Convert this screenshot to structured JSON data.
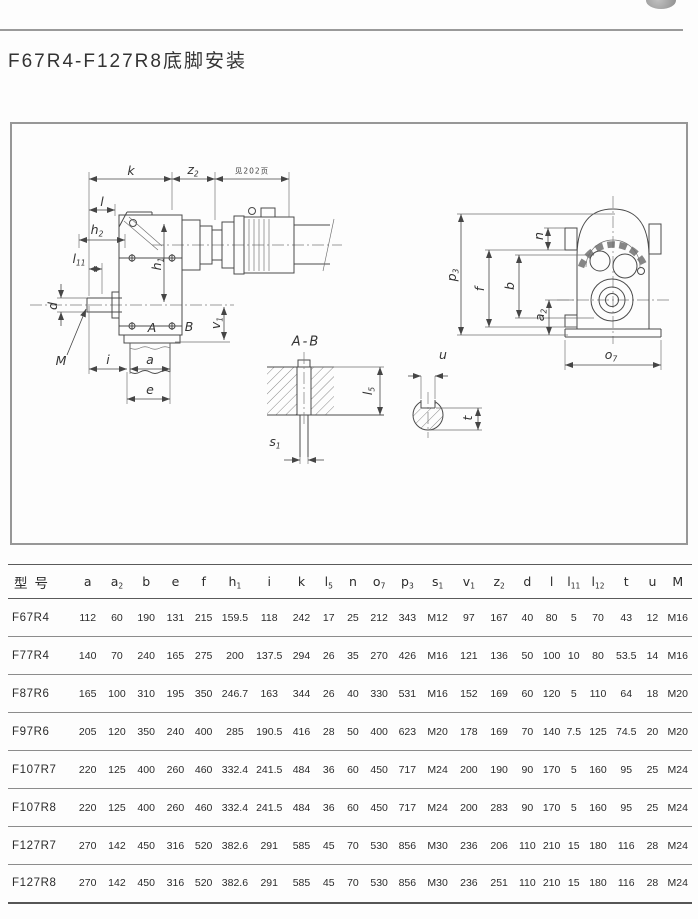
{
  "page": {
    "title": "F67R4-F127R8底脚安装"
  },
  "drawing": {
    "dims": {
      "k": {
        "base": "k",
        "sub": ""
      },
      "z2": {
        "base": "z",
        "sub": "2"
      },
      "note": {
        "base": "见202页",
        "sub": ""
      },
      "l": {
        "base": "l",
        "sub": ""
      },
      "h2": {
        "base": "h",
        "sub": "2"
      },
      "l11": {
        "base": "l",
        "sub": "11"
      },
      "d": {
        "base": "d",
        "sub": ""
      },
      "M": {
        "base": "M",
        "sub": ""
      },
      "i": {
        "base": "i",
        "sub": ""
      },
      "a": {
        "base": "a",
        "sub": ""
      },
      "e": {
        "base": "e",
        "sub": ""
      },
      "h1": {
        "base": "h",
        "sub": "1"
      },
      "A": {
        "base": "A",
        "sub": ""
      },
      "B": {
        "base": "B",
        "sub": ""
      },
      "v1": {
        "base": "v",
        "sub": "1"
      },
      "section": {
        "base": "A-B",
        "sub": ""
      },
      "s1": {
        "base": "s",
        "sub": "1"
      },
      "l5": {
        "base": "l",
        "sub": "5"
      },
      "u": {
        "base": "u",
        "sub": ""
      },
      "t": {
        "base": "t",
        "sub": ""
      },
      "p3": {
        "base": "p",
        "sub": "3"
      },
      "f": {
        "base": "f",
        "sub": ""
      },
      "b": {
        "base": "b",
        "sub": ""
      },
      "n": {
        "base": "n",
        "sub": ""
      },
      "a2": {
        "base": "a",
        "sub": "2"
      },
      "o7": {
        "base": "o",
        "sub": "7"
      }
    }
  },
  "table": {
    "headers": [
      {
        "base": "型号",
        "sub": ""
      },
      {
        "base": "a",
        "sub": ""
      },
      {
        "base": "a",
        "sub": "2"
      },
      {
        "base": "b",
        "sub": ""
      },
      {
        "base": "e",
        "sub": ""
      },
      {
        "base": "f",
        "sub": ""
      },
      {
        "base": "h",
        "sub": "1"
      },
      {
        "base": "i",
        "sub": ""
      },
      {
        "base": "k",
        "sub": ""
      },
      {
        "base": "l",
        "sub": "5"
      },
      {
        "base": "n",
        "sub": ""
      },
      {
        "base": "o",
        "sub": "7"
      },
      {
        "base": "p",
        "sub": "3"
      },
      {
        "base": "s",
        "sub": "1"
      },
      {
        "base": "v",
        "sub": "1"
      },
      {
        "base": "z",
        "sub": "2"
      },
      {
        "base": "d",
        "sub": ""
      },
      {
        "base": "l",
        "sub": ""
      },
      {
        "base": "l",
        "sub": "11"
      },
      {
        "base": "l",
        "sub": "12"
      },
      {
        "base": "t",
        "sub": ""
      },
      {
        "base": "u",
        "sub": ""
      },
      {
        "base": "M",
        "sub": ""
      }
    ],
    "rows": [
      {
        "model": "F67R4",
        "values": [
          "112",
          "60",
          "190",
          "131",
          "215",
          "159.5",
          "118",
          "242",
          "17",
          "25",
          "212",
          "343",
          "M12",
          "97",
          "167",
          "40",
          "80",
          "5",
          "70",
          "43",
          "12",
          "M16"
        ]
      },
      {
        "model": "F77R4",
        "values": [
          "140",
          "70",
          "240",
          "165",
          "275",
          "200",
          "137.5",
          "294",
          "26",
          "35",
          "270",
          "426",
          "M16",
          "121",
          "136",
          "50",
          "100",
          "10",
          "80",
          "53.5",
          "14",
          "M16"
        ]
      },
      {
        "model": "F87R6",
        "values": [
          "165",
          "100",
          "310",
          "195",
          "350",
          "246.7",
          "163",
          "344",
          "26",
          "40",
          "330",
          "531",
          "M16",
          "152",
          "169",
          "60",
          "120",
          "5",
          "110",
          "64",
          "18",
          "M20"
        ]
      },
      {
        "model": "F97R6",
        "values": [
          "205",
          "120",
          "350",
          "240",
          "400",
          "285",
          "190.5",
          "416",
          "28",
          "50",
          "400",
          "623",
          "M20",
          "178",
          "169",
          "70",
          "140",
          "7.5",
          "125",
          "74.5",
          "20",
          "M20"
        ]
      },
      {
        "model": "F107R7",
        "values": [
          "220",
          "125",
          "400",
          "260",
          "460",
          "332.4",
          "241.5",
          "484",
          "36",
          "60",
          "450",
          "717",
          "M24",
          "200",
          "190",
          "90",
          "170",
          "5",
          "160",
          "95",
          "25",
          "M24"
        ]
      },
      {
        "model": "F107R8",
        "values": [
          "220",
          "125",
          "400",
          "260",
          "460",
          "332.4",
          "241.5",
          "484",
          "36",
          "60",
          "450",
          "717",
          "M24",
          "200",
          "283",
          "90",
          "170",
          "5",
          "160",
          "95",
          "25",
          "M24"
        ]
      },
      {
        "model": "F127R7",
        "values": [
          "270",
          "142",
          "450",
          "316",
          "520",
          "382.6",
          "291",
          "585",
          "45",
          "70",
          "530",
          "856",
          "M30",
          "236",
          "206",
          "110",
          "210",
          "15",
          "180",
          "116",
          "28",
          "M24"
        ]
      },
      {
        "model": "F127R8",
        "values": [
          "270",
          "142",
          "450",
          "316",
          "520",
          "382.6",
          "291",
          "585",
          "45",
          "70",
          "530",
          "856",
          "M30",
          "236",
          "251",
          "110",
          "210",
          "15",
          "180",
          "116",
          "28",
          "M24"
        ]
      }
    ]
  }
}
